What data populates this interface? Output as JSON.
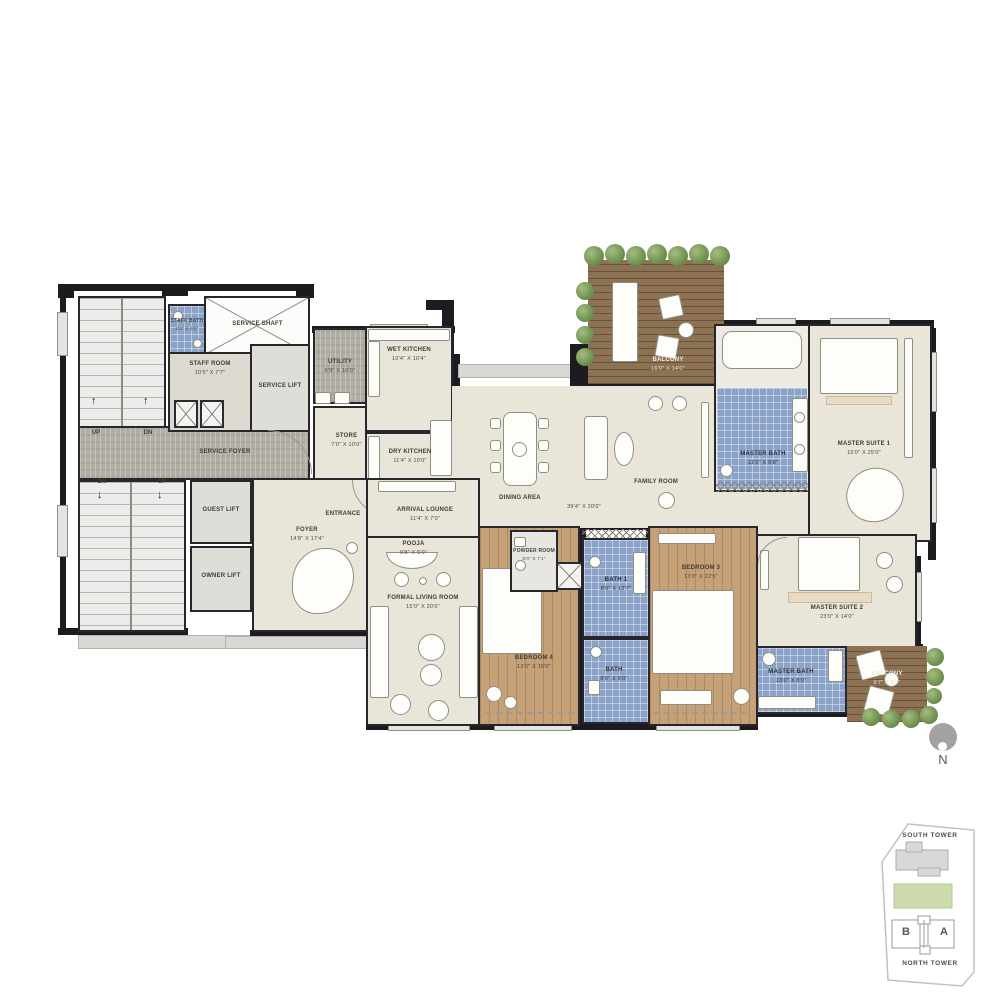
{
  "plan_title": "Residential Unit Floor Plan",
  "colors": {
    "bath_tile_blue": "#8ba3c9",
    "bedroom_wood": "#c6a077",
    "balcony_deck": "#8c7153",
    "plant_green": "#6f9150",
    "service_gray": "#b2ada5",
    "floor_beige": "#e9e6d9",
    "wall_black": "#1b1b20",
    "keyplan_green": "#cbdcaa"
  },
  "rooms": {
    "service_shaft": {
      "name": "SERVICE SHAFT"
    },
    "staff_bath": {
      "name": "STAFF BATH",
      "dims": "4'3\" X 6'0\""
    },
    "staff_room": {
      "name": "STAFF ROOM",
      "dims": "10'5\" X 7'7\""
    },
    "service_lift": {
      "name": "SERVICE LIFT"
    },
    "service_foyer": {
      "name": "SERVICE FOYER"
    },
    "utility": {
      "name": "UTILITY",
      "dims": "6'9\" X 10'0\""
    },
    "store": {
      "name": "STORE",
      "dims": "7'0\" X 10'0\""
    },
    "wet_kitchen": {
      "name": "WET KITCHEN",
      "dims": "10'4\" X 10'4\""
    },
    "dry_kitchen": {
      "name": "DRY KITCHEN",
      "dims": "11'4\" X 10'0\""
    },
    "guest_lift": {
      "name": "GUEST LIFT"
    },
    "owner_lift": {
      "name": "OWNER LIFT"
    },
    "entrance": {
      "name": "ENTRANCE"
    },
    "foyer": {
      "name": "FOYER",
      "dims": "14'8\" X 17'4\""
    },
    "arrival_lounge": {
      "name": "ARRIVAL LOUNGE",
      "dims": "11'4\" X 7'0\""
    },
    "pooja": {
      "name": "POOJA",
      "dims": "9'8\" X 5'0\""
    },
    "formal_living": {
      "name": "FORMAL LIVING ROOM",
      "dims": "15'0\" X 20'0\""
    },
    "dining": {
      "name": "DINING AREA",
      "dims": "39'4\" X 20'0\""
    },
    "family": {
      "name": "FAMILY ROOM"
    },
    "balcony_top": {
      "name": "BALCONY",
      "dims": "16'0\" X 14'0\""
    },
    "master_bath1": {
      "name": "MASTER BATH",
      "dims": "11'0\" X 9'8\""
    },
    "master_suite1": {
      "name": "MASTER SUITE 1",
      "dims": "15'0\" X 25'0\""
    },
    "master_suite2": {
      "name": "MASTER SUITE 2",
      "dims": "23'0\" X 14'0\""
    },
    "master_bath2": {
      "name": "MASTER BATH",
      "dims": "13'0\" X 8'0\""
    },
    "balcony_br": {
      "name": "BALCONY",
      "dims": "9'7\" X 8'0\""
    },
    "powder_room": {
      "name": "POWDER ROOM",
      "dims": "5'0\" X 7'1\""
    },
    "bath1": {
      "name": "BATH 1",
      "dims": "8'0\" X 12'7\""
    },
    "bath2": {
      "name": "BATH",
      "dims": "8'0\" X 9'0\""
    },
    "bedroom3": {
      "name": "BEDROOM 3",
      "dims": "13'0\" X 22'5\""
    },
    "bedroom4": {
      "name": "BEDROOM 4",
      "dims": "13'0\" X 15'0\""
    }
  },
  "stairs": {
    "up": "UP",
    "dn": "DN"
  },
  "north_indicator": {
    "label": "N"
  },
  "keyplan": {
    "south_tower": "SOUTH TOWER",
    "north_tower": "NORTH TOWER",
    "unit_b": "B",
    "unit_a": "A"
  }
}
